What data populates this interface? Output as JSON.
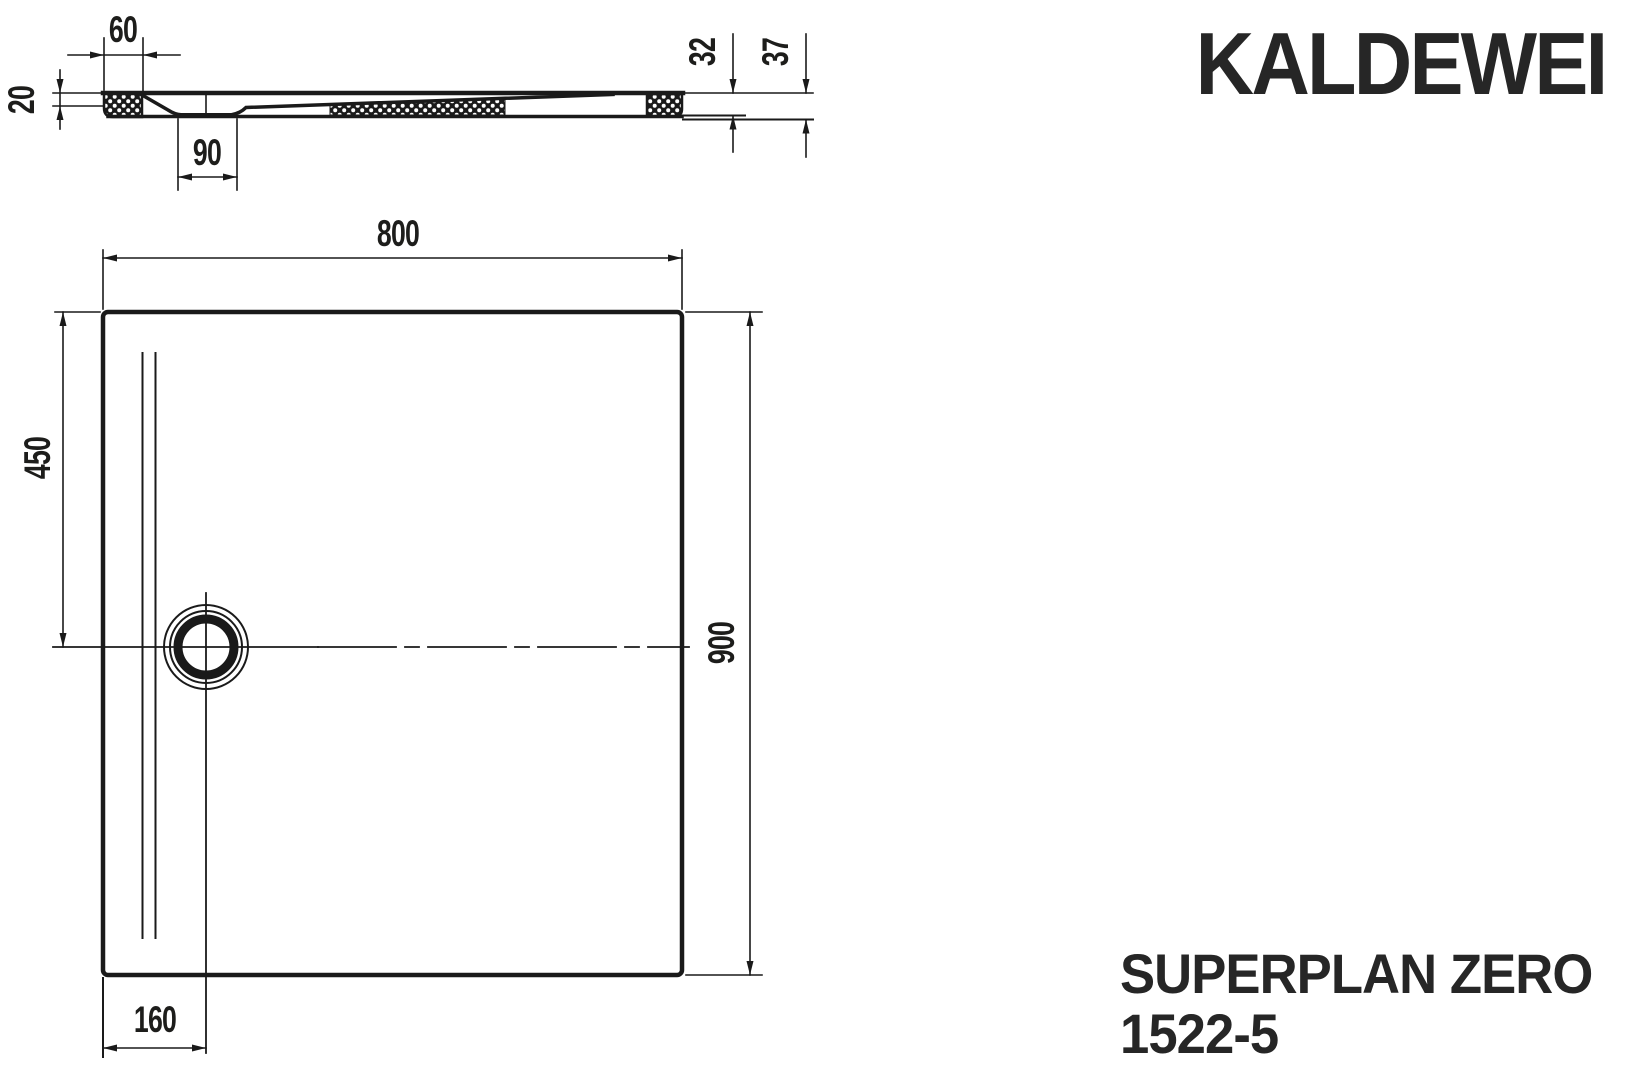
{
  "brand": {
    "logo": "KALDEWEI"
  },
  "product": {
    "name": "SUPERPLAN ZERO",
    "model": "1522-5"
  },
  "dimensions": {
    "section": {
      "rim_width": "60",
      "rim_height": "20",
      "waste_recess_width": "90",
      "tray_height": "32",
      "total_height": "37"
    },
    "plan": {
      "width": "800",
      "length": "900",
      "drain_offset_top": "450",
      "drain_offset_left": "160"
    }
  },
  "colors": {
    "line": "#1a1a1a",
    "text": "#1d1d1b"
  }
}
